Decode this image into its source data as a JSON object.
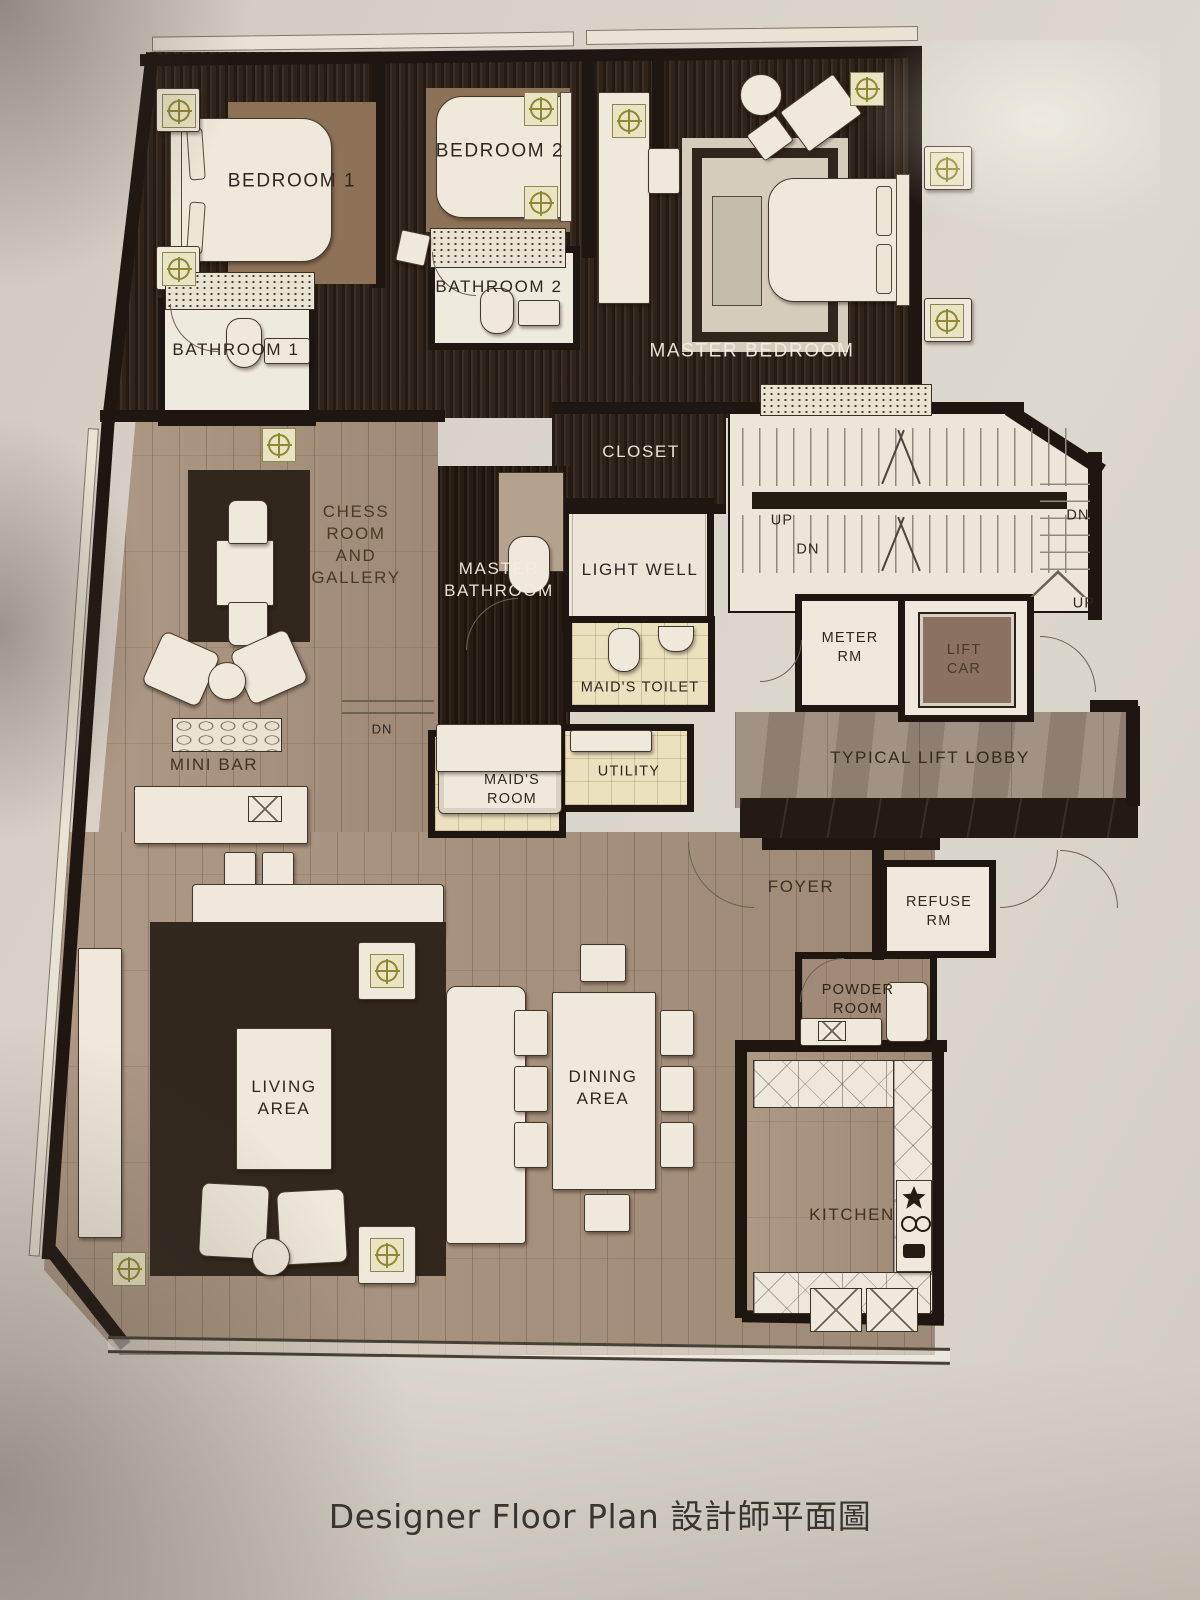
{
  "photo": {
    "caption": "Designer Floor Plan 設計師平面圖"
  },
  "plan": {
    "rooms": {
      "bedroom_1": "BEDROOM 1",
      "bedroom_2": "BEDROOM 2",
      "master_bedroom": "MASTER BEDROOM",
      "bathroom_1": "BATHROOM 1",
      "bathroom_2": "BATHROOM 2",
      "closet": "CLOSET",
      "chess_room": "CHESS\nROOM\nAND\nGALLERY",
      "master_bathroom": "MASTER\nBATHROOM",
      "light_well": "LIGHT WELL",
      "maids_toilet": "MAID'S TOILET",
      "maids_room": "MAID'S\nROOM",
      "utility": "UTILITY",
      "meter_room": "METER\nRM",
      "lift_car": "LIFT\nCAR",
      "lift_lobby": "TYPICAL LIFT LOBBY",
      "foyer": "FOYER",
      "refuse_room": "REFUSE\nRM",
      "powder_room": "POWDER\nROOM",
      "kitchen": "KITCHEN",
      "mini_bar": "MINI BAR",
      "living_area": "LIVING\nAREA",
      "dining_area": "DINING\nAREA"
    },
    "stairs": {
      "up_left": "UP",
      "dn_left": "DN",
      "dn_right": "DN",
      "up_right": "UP",
      "dn_hall": "DN"
    },
    "colors": {
      "paper": "#d6d0c6",
      "wall": "#1e1610",
      "dark_wood": "#30241a",
      "light_wood": "#a8927c",
      "pale_tile": "#ebe1bf",
      "stair_cream": "#ebe6d8",
      "lobby_marble": "#9a897a",
      "lift_car_brown": "#8a7260",
      "accent_olive": "#8f8830",
      "label_dark": "#2e2822",
      "label_light": "#f3ecde"
    }
  }
}
